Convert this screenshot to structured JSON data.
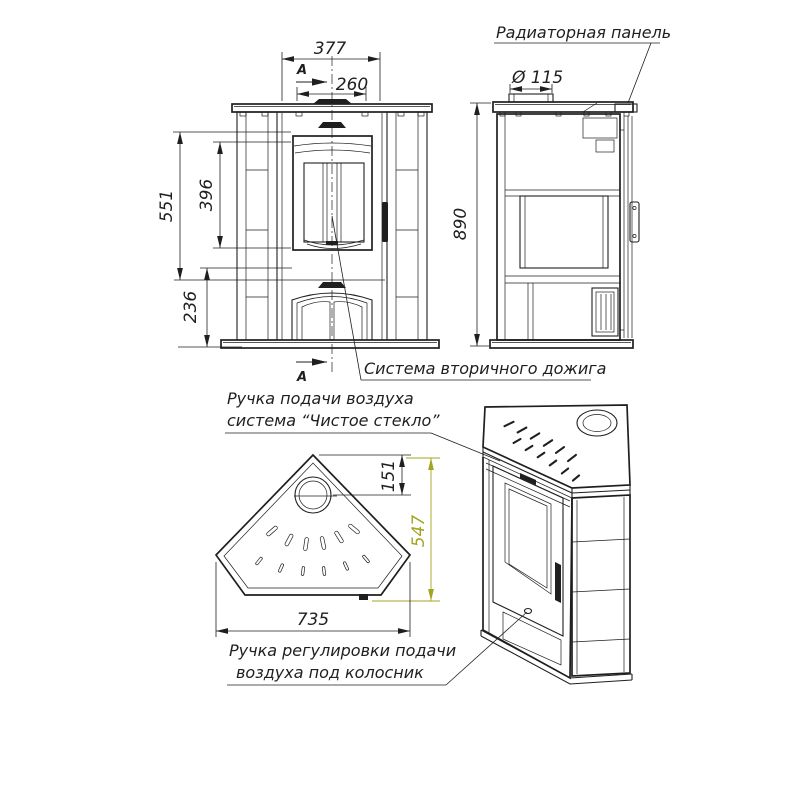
{
  "colors": {
    "ink": "#1f1f1f",
    "accent_dimension": "#a3a41f",
    "background": "#ffffff"
  },
  "section_mark": "A",
  "labels": {
    "radiator_panel": "Радиаторная панель",
    "secondary_combustion": "Система вторичного дожига",
    "air_handle_line1": "Ручка подачи воздуха",
    "air_handle_line2": "система “Чистое стекло”",
    "grate_air_line1": "Ручка регулировки подачи",
    "grate_air_line2": "воздуха под колосник"
  },
  "dimensions": {
    "front_facet_width": "377",
    "door_glass_width": "260",
    "upper_section_height": "551",
    "glass_height": "396",
    "plinth_height": "236",
    "flue_diameter": "Ø 115",
    "overall_height": "890",
    "flue_center_offset": "151",
    "top_depth": "547",
    "top_width": "735"
  }
}
